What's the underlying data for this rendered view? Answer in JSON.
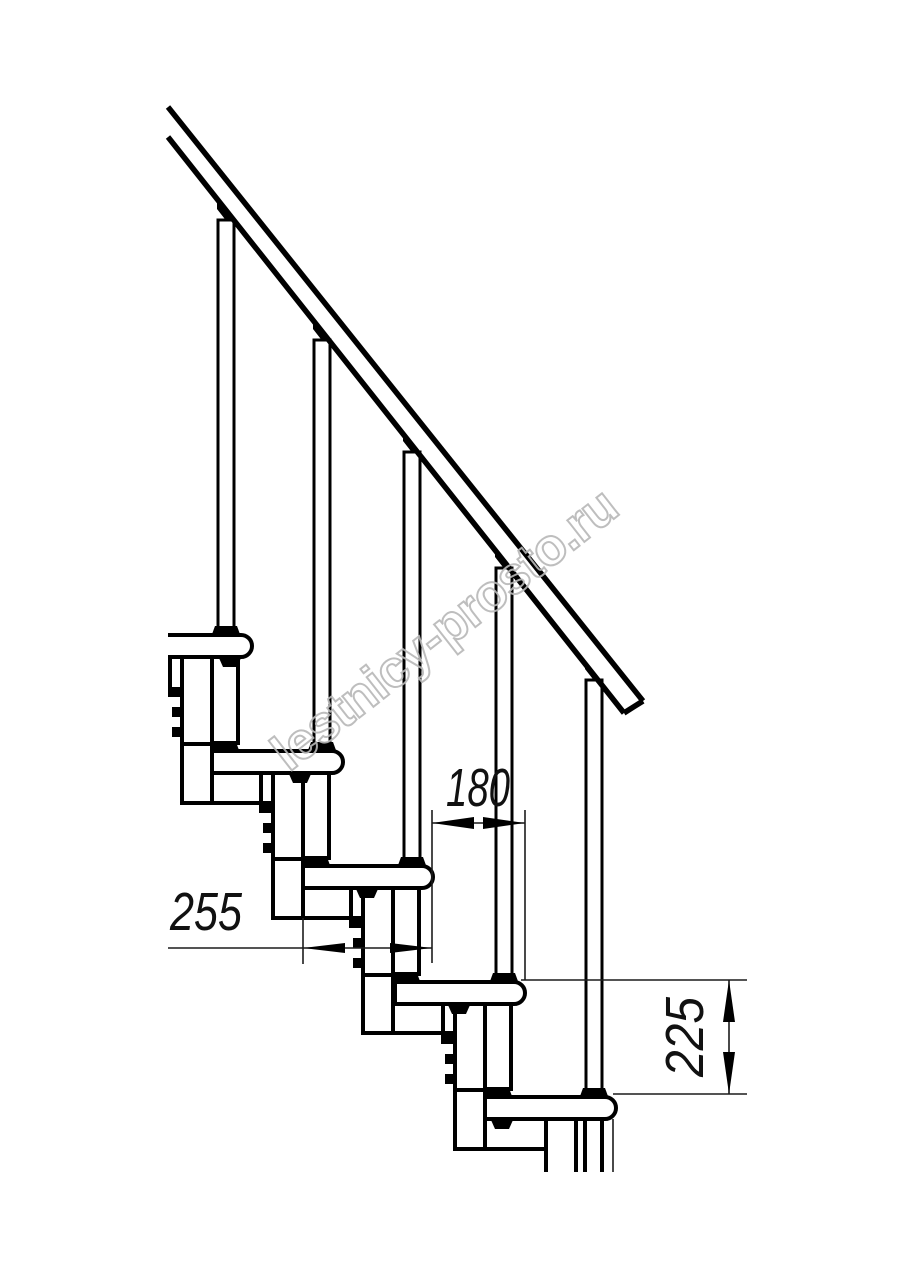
{
  "page": {
    "background_color": "#ffffff"
  },
  "watermark": {
    "text": "lestnicy-prosto.ru",
    "color": "#b8b8b8"
  },
  "drawing": {
    "subject": "modular-staircase-side-view",
    "line_color": "#000000",
    "steps_visible": 5,
    "balusters_visible": 5
  },
  "dimensions": {
    "run": {
      "value": "180",
      "orientation": "horizontal"
    },
    "tread": {
      "value": "255",
      "orientation": "horizontal"
    },
    "rise": {
      "value": "225",
      "orientation": "vertical"
    }
  }
}
